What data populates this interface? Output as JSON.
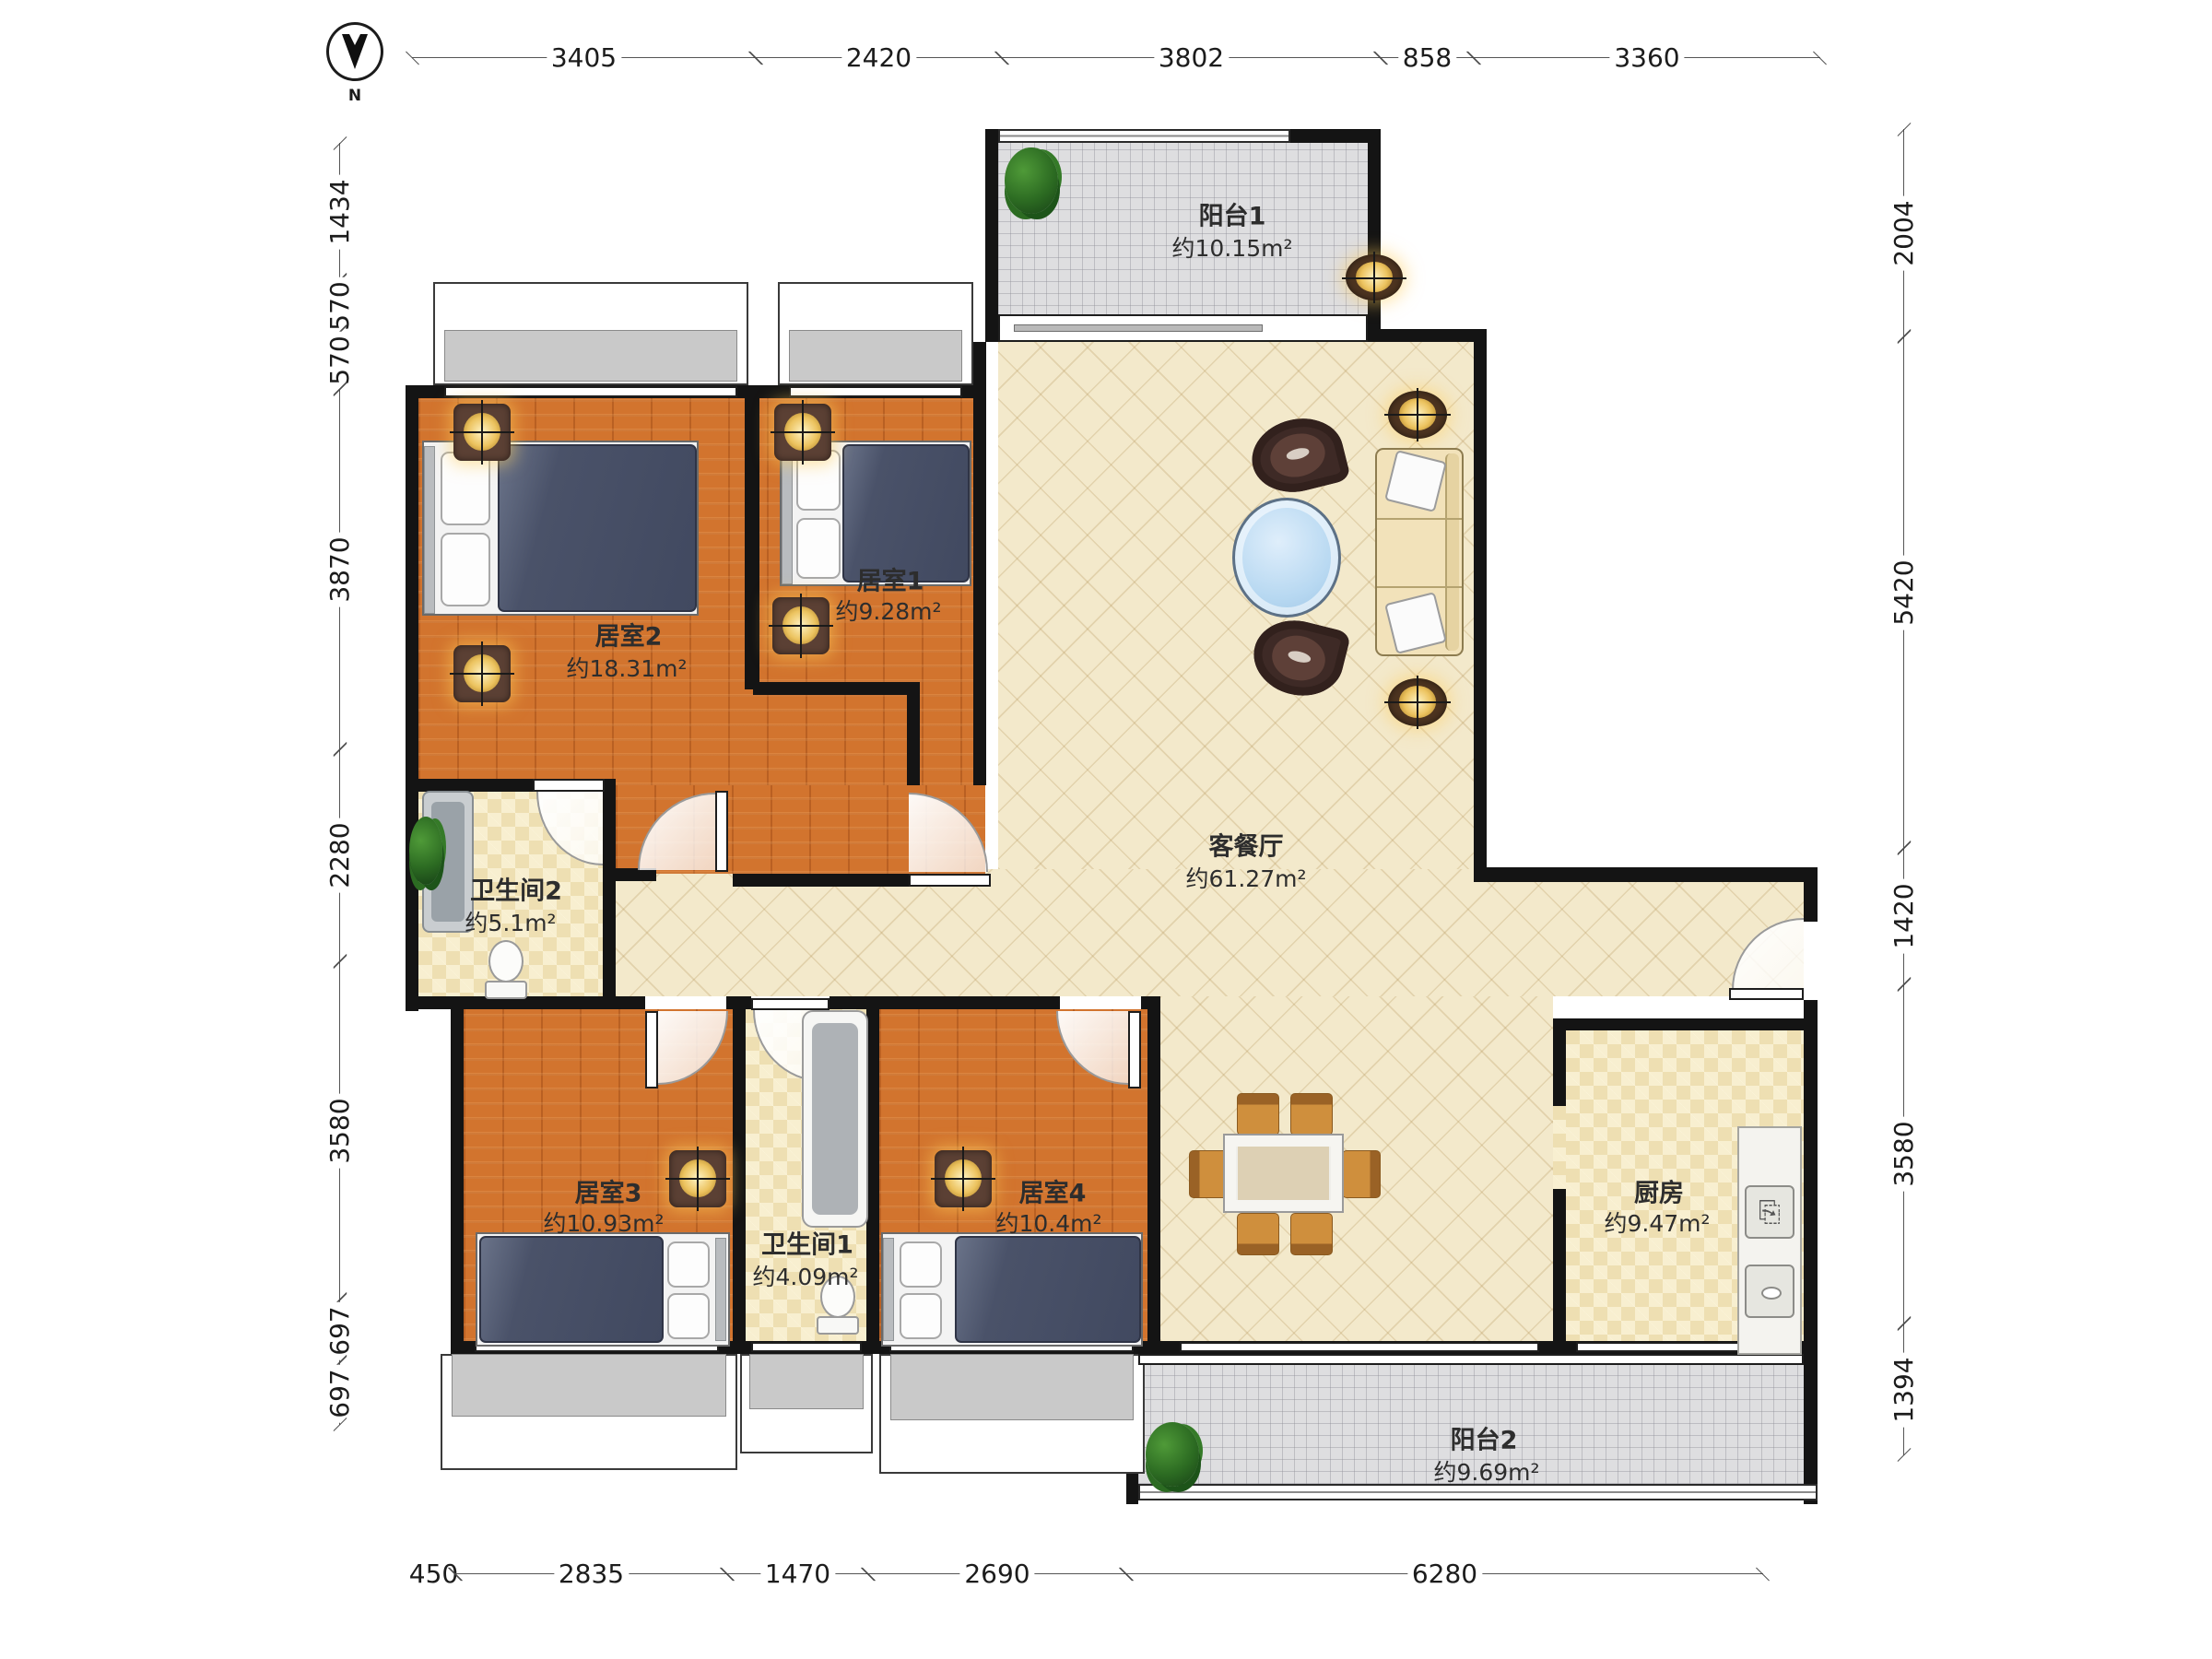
{
  "north_label": "N",
  "dimensions": {
    "top": [
      "3405",
      "2420",
      "3802",
      "858",
      "3360"
    ],
    "left": [
      "1434",
      "570",
      "570",
      "3870",
      "2280",
      "3580",
      "697",
      "697"
    ],
    "right": [
      "2004",
      "5420",
      "1420",
      "3580",
      "1394"
    ],
    "bottom": [
      "450",
      "2835",
      "1470",
      "2690",
      "6280"
    ]
  },
  "rooms": [
    {
      "name": "阳台1",
      "area": "约10.15m²"
    },
    {
      "name": "居室2",
      "area": "约18.31m²"
    },
    {
      "name": "居室1",
      "area": "约9.28m²"
    },
    {
      "name": "客餐厅",
      "area": "约61.27m²"
    },
    {
      "name": "卫生间2",
      "area": "约5.1m²"
    },
    {
      "name": "居室3",
      "area": "约10.93m²"
    },
    {
      "name": "卫生间1",
      "area": "约4.09m²"
    },
    {
      "name": "居室4",
      "area": "约10.4m²"
    },
    {
      "name": "厨房",
      "area": "约9.47m²"
    },
    {
      "name": "阳台2",
      "area": "约9.69m²"
    }
  ],
  "colors": {
    "wall": "#141414",
    "wood_floor": "#d2742e",
    "living_floor": "#f3e9cb",
    "tile_floor": "#eedfb2",
    "balcony_floor": "#dedee0",
    "blanket_navy": "#4a5269",
    "sofa_cream": "#f2e2ba",
    "chair_wood": "#cf8f3d",
    "armchair_brown": "#3e2a26",
    "glass_blue": "#b7d8f1",
    "lamp_gold": "#ecc35f"
  }
}
